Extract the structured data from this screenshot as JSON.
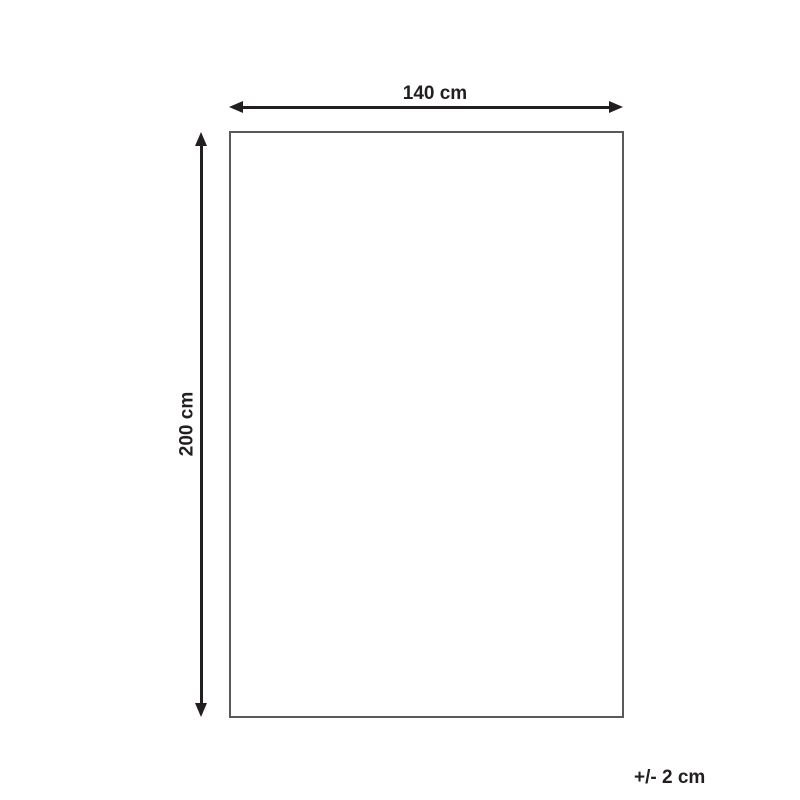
{
  "diagram": {
    "width_label": "140 cm",
    "height_label": "200 cm",
    "tolerance_label": "+/- 2 cm"
  },
  "colors": {
    "arrow": "#231f20",
    "outline": "#58595b",
    "background": "#ffffff"
  }
}
